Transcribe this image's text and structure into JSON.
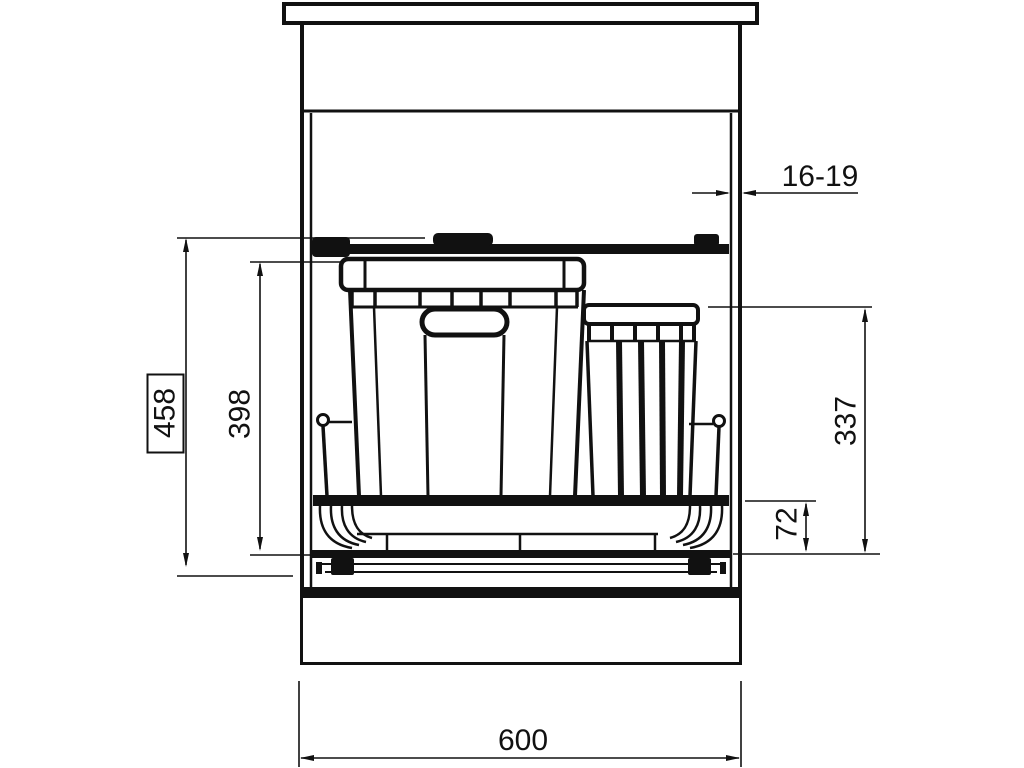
{
  "colors": {
    "line": "#111111",
    "background": "#ffffff"
  },
  "dimensions": {
    "panel_thickness": {
      "label": "16-19"
    },
    "pullout_height": {
      "label": "458"
    },
    "large_bin_height": {
      "label": "398"
    },
    "small_bin_height": {
      "label": "337"
    },
    "bottom_frame_height": {
      "label": "72"
    },
    "cabinet_width": {
      "label": "600"
    }
  }
}
